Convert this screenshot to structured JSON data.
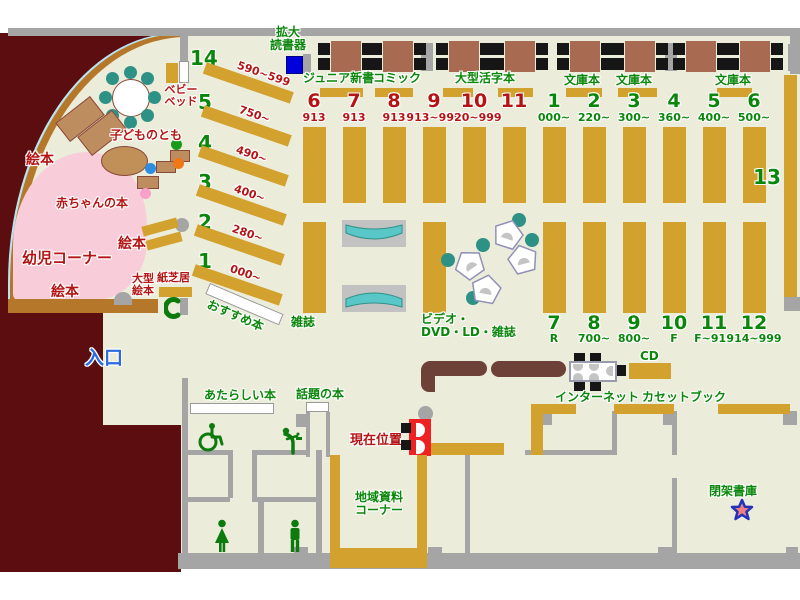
{
  "colors": {
    "floor": "#ececda",
    "outside": "#5c0d0f",
    "wall": "#a5a5a5",
    "shelf": "#d2a12e",
    "shelf_border": "#7a1a10",
    "table": "#a86a50",
    "counter": "#6d4038",
    "green": "#0a870a",
    "red": "#b51414",
    "blue": "#2a6ae0",
    "pink": "#f9ccd9",
    "teal": "#2e9186",
    "rack": "#59c7c7",
    "marker": "#ee2222",
    "device_blue": "#0000dd",
    "star_fill": "#f28080",
    "star_stroke": "#2233bb",
    "curve_brown": "#b5782a",
    "curve_blue": "#b8e4f2"
  },
  "top": {
    "magnifier_line1": "拡大",
    "magnifier_line2": "読書器",
    "shelf_labels": [
      "ジュニア新書",
      "コミック",
      "大型活字本",
      "文庫本",
      "文庫本",
      "文庫本"
    ]
  },
  "sections": {
    "red_top": [
      {
        "no": "6",
        "range": "913"
      },
      {
        "no": "7",
        "range": "913"
      },
      {
        "no": "8",
        "range": "913"
      },
      {
        "no": "9",
        "range": "913~919"
      },
      {
        "no": "10",
        "range": "920~999"
      },
      {
        "no": "11",
        "range": ""
      }
    ],
    "green_top": [
      {
        "no": "1",
        "range": "000~"
      },
      {
        "no": "2",
        "range": "220~"
      },
      {
        "no": "3",
        "range": "300~"
      },
      {
        "no": "4",
        "range": "360~"
      },
      {
        "no": "5",
        "range": "400~"
      },
      {
        "no": "6",
        "range": "500~"
      }
    ],
    "green_bottom": [
      {
        "no": "7",
        "range": "R"
      },
      {
        "no": "8",
        "range": "700~"
      },
      {
        "no": "9",
        "range": "800~"
      },
      {
        "no": "10",
        "range": "F"
      },
      {
        "no": "11",
        "range": "F~914"
      },
      {
        "no": "12",
        "range": "914~999"
      }
    ],
    "shelf13": "13"
  },
  "diagonal": [
    {
      "no": "14",
      "range": "590~599"
    },
    {
      "no": "5",
      "range": "750~"
    },
    {
      "no": "4",
      "range": "490~"
    },
    {
      "no": "3",
      "range": "400~"
    },
    {
      "no": "2",
      "range": "280~"
    },
    {
      "no": "1",
      "range": "000~"
    }
  ],
  "children": {
    "baby_bed_line1": "ベビー",
    "baby_bed_line2": "ベッド",
    "kodomonotomo": "子どものとも",
    "ehon_left": "絵本",
    "ehon_mid": "絵本",
    "ehon_bottom": "絵本",
    "akachan": "赤ちゃんの本",
    "youji_corner": "幼児コーナー",
    "ogata_line1": "大型",
    "ogata_line2": "絵本",
    "kamishibai": "紙芝居",
    "osusume": "おすすめ本"
  },
  "center_area": {
    "zasshi": "雑誌",
    "video_line1": "ビデオ・",
    "video_line2": "DVD・LD・雑誌"
  },
  "facilities": {
    "entrance": "入口",
    "new_books": "あたらしい本",
    "topic_books": "話題の本",
    "current_position": "現在位置",
    "internet": "インターネット",
    "cd": "CD",
    "cassette_book": "カセットブック",
    "chiiki_line1": "地域資料",
    "chiiki_line2": "コーナー",
    "closed_stack": "閉架書庫"
  }
}
